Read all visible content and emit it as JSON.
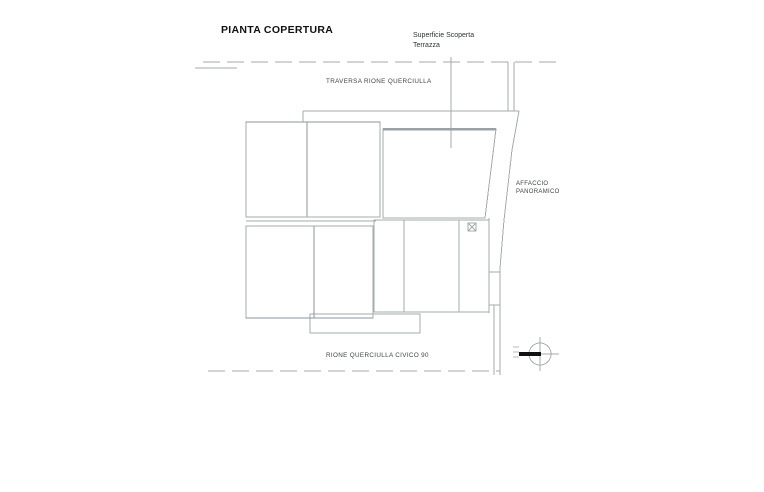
{
  "drawing": {
    "title": "PIANTA COPERTURA",
    "annotations": {
      "surface": {
        "line1": "Superficie Scoperta",
        "line2": "Terrazza"
      },
      "street_top": "TRAVERSA RIONE QUERCIULLA",
      "street_bottom": "RIONE QUERCIULLA CIVICO 90",
      "affaccio": {
        "line1": "AFFACCIO",
        "line2": "PANORAMICO"
      }
    },
    "icons": {
      "north_arrow": "north-arrow-icon",
      "roof_vent": "roof-vent-x-box-icon"
    },
    "colors": {
      "background": "#ffffff",
      "line": "#a6abae",
      "line_dark": "#8f9599",
      "hatch": "#cdd0d2",
      "grid": "#c6cacc",
      "text": "#3f4447",
      "title": "#111111",
      "north": "#111111"
    }
  }
}
